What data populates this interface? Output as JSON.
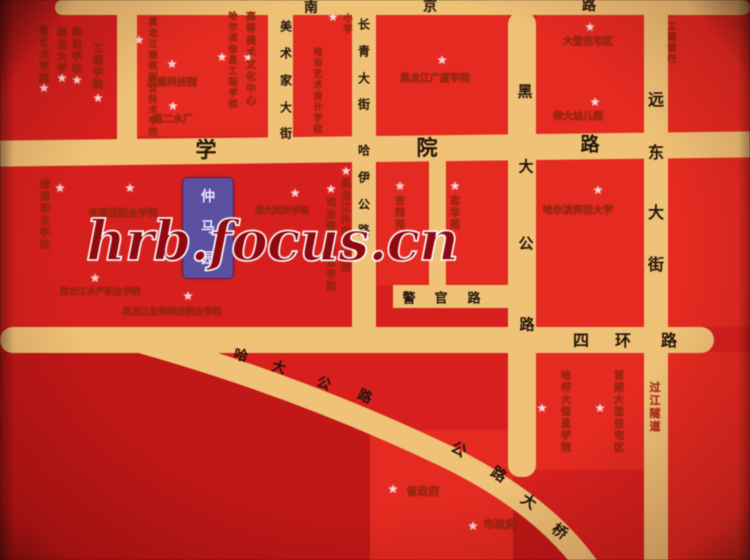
{
  "watermark": {
    "text": "hrb.focus.cn"
  },
  "project_marker": {
    "name": "仲马园"
  },
  "colors": {
    "background": "#d7201d",
    "block": "#e52a21",
    "block_dark": "#c21717",
    "road": "#efc277",
    "road_text": "#221408",
    "label_text": "#962a0f",
    "label_text_bright": "#b3261a",
    "star": "#ffd9d9",
    "watermark_text": "#8e0a10",
    "watermark_outline": "#ffffff",
    "marker_bg": "#5b4fa0",
    "marker_text": "#efe7ff"
  },
  "roads": [
    "南京路",
    "学院路",
    "四环路",
    "警官路",
    "美术家大街",
    "长青大街",
    "哈伊公路",
    "黑大公路",
    "远东大街",
    "哈大公路",
    "公路大桥"
  ],
  "road_labels": [
    {
      "name": "南京路",
      "chars": [
        [
          "南",
          311,
          7,
          14,
          0
        ],
        [
          "京",
          430,
          6,
          14,
          0
        ],
        [
          "路",
          589,
          5,
          14,
          0
        ]
      ]
    },
    {
      "name": "学院路",
      "chars": [
        [
          "学",
          206,
          149,
          21,
          0
        ],
        [
          "院",
          427,
          147,
          21,
          0
        ],
        [
          "路",
          590,
          143,
          19,
          0
        ]
      ]
    },
    {
      "name": "美术家大街",
      "chars": [
        [
          "美",
          286,
          26,
          12,
          0
        ],
        [
          "术",
          286,
          53,
          12,
          0
        ],
        [
          "家",
          286,
          80,
          12,
          0
        ],
        [
          "大",
          286,
          107,
          12,
          0
        ],
        [
          "街",
          286,
          133,
          12,
          0
        ]
      ]
    },
    {
      "name": "长青大街",
      "chars": [
        [
          "长",
          364,
          24,
          12,
          0
        ],
        [
          "青",
          364,
          51,
          12,
          0
        ],
        [
          "大",
          364,
          78,
          12,
          0
        ],
        [
          "街",
          364,
          104,
          12,
          0
        ]
      ]
    },
    {
      "name": "哈伊公路",
      "chars": [
        [
          "哈",
          364,
          150,
          12,
          0
        ],
        [
          "伊",
          364,
          177,
          12,
          0
        ],
        [
          "公",
          364,
          204,
          12,
          0
        ],
        [
          "路",
          364,
          230,
          12,
          0
        ]
      ]
    },
    {
      "name": "黑大公路",
      "chars": [
        [
          "黑",
          525,
          91,
          15,
          0
        ],
        [
          "大",
          526,
          166,
          15,
          0
        ],
        [
          "公",
          526,
          243,
          15,
          0
        ],
        [
          "路",
          527,
          324,
          15,
          0
        ]
      ]
    },
    {
      "name": "远东大街",
      "chars": [
        [
          "远",
          656,
          98,
          16,
          0
        ],
        [
          "东",
          656,
          151,
          16,
          0
        ],
        [
          "大",
          656,
          211,
          16,
          0
        ],
        [
          "街",
          656,
          263,
          16,
          0
        ]
      ]
    },
    {
      "name": "四环路",
      "chars": [
        [
          "四",
          581,
          339,
          16,
          0
        ],
        [
          "环",
          623,
          339,
          16,
          0
        ],
        [
          "路",
          669,
          339,
          16,
          0
        ]
      ]
    },
    {
      "name": "警官路",
      "chars": [
        [
          "警",
          409,
          297,
          13,
          0
        ],
        [
          "官",
          441,
          297,
          13,
          0
        ],
        [
          "路",
          474,
          297,
          13,
          0
        ]
      ]
    },
    {
      "name": "哈大公路",
      "chars": [
        [
          "哈",
          241,
          355,
          14,
          12
        ],
        [
          "大",
          279,
          367,
          14,
          16
        ],
        [
          "公",
          324,
          383,
          14,
          20
        ],
        [
          "路",
          365,
          396,
          14,
          24
        ]
      ]
    },
    {
      "name": "公路大桥",
      "chars": [
        [
          "公",
          459,
          449,
          15,
          30
        ],
        [
          "路",
          499,
          474,
          15,
          32
        ],
        [
          "大",
          529,
          501,
          15,
          34
        ],
        [
          "桥",
          560,
          531,
          15,
          36
        ]
      ]
    }
  ],
  "landmarks_vertical": [
    {
      "text": "省艺术学院",
      "x": 44,
      "y": 26,
      "fs": 10
    },
    {
      "text": "商业大学",
      "x": 62,
      "y": 28,
      "fs": 10
    },
    {
      "text": "师范学校",
      "x": 77,
      "y": 28,
      "fs": 10
    },
    {
      "text": "工程学院",
      "x": 98,
      "y": 44,
      "fs": 10
    },
    {
      "text": "黑龙江建筑职业技术学院",
      "x": 153,
      "y": 18,
      "fs": 9
    },
    {
      "text": "哈尔滨信息工程学院",
      "x": 233,
      "y": 12,
      "fs": 9
    },
    {
      "text": "高等美术文化中心",
      "x": 251,
      "y": 12,
      "fs": 10
    },
    {
      "text": "哈市艺术设计学校",
      "x": 318,
      "y": 48,
      "fs": 9
    },
    {
      "text": "小学",
      "x": 348,
      "y": 14,
      "fs": 9
    },
    {
      "text": "工商银行",
      "x": 672,
      "y": 22,
      "fs": 9
    },
    {
      "text": "绿博职业学校",
      "x": 45,
      "y": 180,
      "fs": 10
    },
    {
      "text": "黑龙江外国语学院",
      "x": 346,
      "y": 179,
      "fs": 10
    },
    {
      "text": "司法警官职业学院",
      "x": 331,
      "y": 198,
      "fs": 10
    },
    {
      "text": "吉翔苑",
      "x": 400,
      "y": 196,
      "fs": 10
    },
    {
      "text": "志华苑",
      "x": 455,
      "y": 196,
      "fs": 10
    },
    {
      "text": "哈师大恒星学院",
      "x": 566,
      "y": 371,
      "fs": 10
    },
    {
      "text": "首期大型住宅区",
      "x": 619,
      "y": 371,
      "fs": 10
    },
    {
      "text": "过江隧道",
      "x": 655,
      "y": 381,
      "fs": 11,
      "bright": true
    }
  ],
  "landmarks_horizontal": [
    {
      "text": "凤凰科技园",
      "x": 172,
      "y": 81,
      "fs": 10
    },
    {
      "text": "第二水厂",
      "x": 173,
      "y": 118,
      "fs": 10
    },
    {
      "text": "黑龙江广厦学院",
      "x": 435,
      "y": 77,
      "fs": 10
    },
    {
      "text": "大型住宅区",
      "x": 588,
      "y": 40,
      "fs": 10
    },
    {
      "text": "师大幼儿园",
      "x": 578,
      "y": 115,
      "fs": 10
    },
    {
      "text": "哈尔滨师范大学",
      "x": 578,
      "y": 209,
      "fs": 10
    },
    {
      "text": "省建设职业学院",
      "x": 123,
      "y": 212,
      "fs": 10
    },
    {
      "text": "黑龙江水产职业学院",
      "x": 100,
      "y": 291,
      "fs": 9
    },
    {
      "text": "黑龙江生物科技职业学院",
      "x": 172,
      "y": 311,
      "fs": 9
    },
    {
      "text": "黑大同庆学院",
      "x": 282,
      "y": 210,
      "fs": 9
    },
    {
      "text": "省政府",
      "x": 423,
      "y": 491,
      "fs": 11
    },
    {
      "text": "市政府",
      "x": 500,
      "y": 524,
      "fs": 11
    }
  ],
  "stars": [
    [
      44,
      88
    ],
    [
      62,
      78
    ],
    [
      77,
      80
    ],
    [
      98,
      98
    ],
    [
      139,
      40
    ],
    [
      172,
      64
    ],
    [
      173,
      106
    ],
    [
      222,
      57
    ],
    [
      248,
      57
    ],
    [
      333,
      17
    ],
    [
      130,
      188
    ],
    [
      60,
      188
    ],
    [
      95,
      278
    ],
    [
      188,
      296
    ],
    [
      295,
      193
    ],
    [
      331,
      189
    ],
    [
      346,
      171
    ],
    [
      400,
      186
    ],
    [
      455,
      186
    ],
    [
      442,
      60
    ],
    [
      590,
      27
    ],
    [
      595,
      102
    ],
    [
      598,
      190
    ],
    [
      542,
      408
    ],
    [
      600,
      408
    ],
    [
      393,
      489
    ],
    [
      473,
      526
    ]
  ]
}
